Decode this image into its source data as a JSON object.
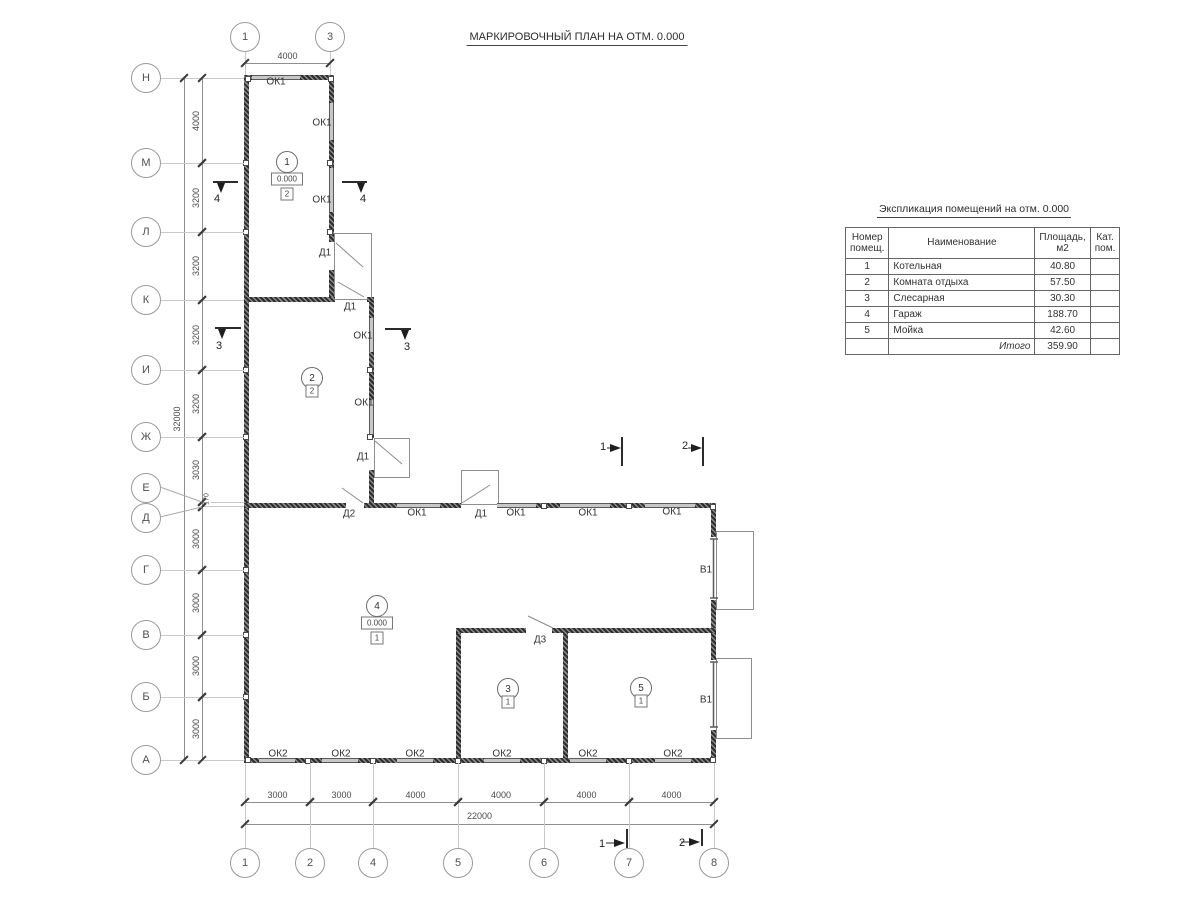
{
  "title": "МАРКИРОВОЧНЫЙ ПЛАН НА ОТМ. 0.000",
  "explication": {
    "title": "Экспликация помещений на отм. 0.000",
    "h_num1": "Номер",
    "h_num2": "помещ.",
    "h_name": "Наименование",
    "h_area": "Площадь,  м2",
    "h_cat1": "Кат.",
    "h_cat2": "пом.",
    "rows": [
      {
        "num": "1",
        "name": "Котельная",
        "area": "40.80",
        "cat": ""
      },
      {
        "num": "2",
        "name": "Комната отдыха",
        "area": "57.50",
        "cat": ""
      },
      {
        "num": "3",
        "name": "Слесарная",
        "area": "30.30",
        "cat": ""
      },
      {
        "num": "4",
        "name": "Гараж",
        "area": "188.70",
        "cat": ""
      },
      {
        "num": "5",
        "name": "Мойка",
        "area": "42.60",
        "cat": ""
      }
    ],
    "total_label": "Итого",
    "total_area": "359.90"
  },
  "axes": {
    "left": [
      {
        "label": "Н",
        "cy": 78
      },
      {
        "label": "М",
        "cy": 163
      },
      {
        "label": "Л",
        "cy": 232
      },
      {
        "label": "К",
        "cy": 300
      },
      {
        "label": "И",
        "cy": 370
      },
      {
        "label": "Ж",
        "cy": 437
      },
      {
        "label": "Е",
        "cy": 488,
        "ly": 502,
        "leader": true
      },
      {
        "label": "Д",
        "cy": 518,
        "ly": 506,
        "leader": true
      },
      {
        "label": "Г",
        "cy": 570
      },
      {
        "label": "В",
        "cy": 635
      },
      {
        "label": "Б",
        "cy": 697
      },
      {
        "label": "А",
        "cy": 760
      }
    ],
    "top": [
      {
        "label": "1",
        "cx": 245
      },
      {
        "label": "3",
        "cx": 330
      }
    ],
    "bottom": [
      {
        "label": "1",
        "cx": 245
      },
      {
        "label": "2",
        "cx": 310
      },
      {
        "label": "4",
        "cx": 373
      },
      {
        "label": "5",
        "cx": 458
      },
      {
        "label": "6",
        "cx": 544
      },
      {
        "label": "7",
        "cx": 629
      },
      {
        "label": "8",
        "cx": 714
      }
    ]
  },
  "dimensions": {
    "left_segments": [
      {
        "text": "4000",
        "y1": 78,
        "y2": 163
      },
      {
        "text": "3200",
        "y1": 163,
        "y2": 232
      },
      {
        "text": "3200",
        "y1": 232,
        "y2": 300
      },
      {
        "text": "3200",
        "y1": 300,
        "y2": 370
      },
      {
        "text": "3200",
        "y1": 370,
        "y2": 437
      },
      {
        "text": "3030",
        "y1": 437,
        "y2": 502
      },
      {
        "text": "170",
        "y1": 502,
        "y2": 507,
        "small": true
      },
      {
        "text": "3000",
        "y1": 507,
        "y2": 570
      },
      {
        "text": "3000",
        "y1": 570,
        "y2": 635
      },
      {
        "text": "3000",
        "y1": 635,
        "y2": 697
      },
      {
        "text": "3000",
        "y1": 697,
        "y2": 760
      }
    ],
    "left_total": {
      "text": "32000",
      "y1": 78,
      "y2": 760
    },
    "bottom_segments": [
      {
        "text": "3000",
        "x1": 245,
        "x2": 310
      },
      {
        "text": "3000",
        "x1": 310,
        "x2": 373
      },
      {
        "text": "4000",
        "x1": 373,
        "x2": 458
      },
      {
        "text": "4000",
        "x1": 458,
        "x2": 544
      },
      {
        "text": "4000",
        "x1": 544,
        "x2": 629
      },
      {
        "text": "4000",
        "x1": 629,
        "x2": 714
      }
    ],
    "bottom_total": {
      "text": "22000",
      "x1": 245,
      "x2": 714
    },
    "top_segments": [
      {
        "text": "4000",
        "x1": 245,
        "x2": 330
      }
    ]
  },
  "rooms": [
    {
      "number": "1",
      "elevation": "0.000",
      "category": "2",
      "x": 287,
      "y": 162
    },
    {
      "number": "2",
      "category": "2",
      "x": 312,
      "y": 378
    },
    {
      "number": "3",
      "category": "1",
      "x": 508,
      "y": 689
    },
    {
      "number": "4",
      "elevation": "0.000",
      "category": "1",
      "x": 377,
      "y": 606
    },
    {
      "number": "5",
      "category": "1",
      "x": 641,
      "y": 688
    }
  ],
  "opening_labels": [
    {
      "text": "ОК1",
      "x": 276,
      "y": 82
    },
    {
      "text": "ОК1",
      "x": 322,
      "y": 123
    },
    {
      "text": "ОК1",
      "x": 322,
      "y": 200
    },
    {
      "text": "Д1",
      "x": 325,
      "y": 253
    },
    {
      "text": "Д1",
      "x": 350,
      "y": 307
    },
    {
      "text": "ОК1",
      "x": 363,
      "y": 336
    },
    {
      "text": "ОК1",
      "x": 364,
      "y": 403
    },
    {
      "text": "Д1",
      "x": 363,
      "y": 457
    },
    {
      "text": "Д2",
      "x": 349,
      "y": 514
    },
    {
      "text": "ОК1",
      "x": 417,
      "y": 513
    },
    {
      "text": "Д1",
      "x": 481,
      "y": 514
    },
    {
      "text": "ОК1",
      "x": 516,
      "y": 513
    },
    {
      "text": "ОК1",
      "x": 588,
      "y": 513
    },
    {
      "text": "ОК1",
      "x": 672,
      "y": 512
    },
    {
      "text": "Д3",
      "x": 540,
      "y": 640
    },
    {
      "text": "В1",
      "x": 706,
      "y": 570
    },
    {
      "text": "В1",
      "x": 706,
      "y": 700
    },
    {
      "text": "ОК2",
      "x": 278,
      "y": 754
    },
    {
      "text": "ОК2",
      "x": 341,
      "y": 754
    },
    {
      "text": "ОК2",
      "x": 415,
      "y": 754
    },
    {
      "text": "ОК2",
      "x": 502,
      "y": 754
    },
    {
      "text": "ОК2",
      "x": 588,
      "y": 754
    },
    {
      "text": "ОК2",
      "x": 673,
      "y": 754
    }
  ],
  "section_labels": [
    {
      "text": "4",
      "x": 217,
      "y": 199
    },
    {
      "text": "4",
      "x": 363,
      "y": 199
    },
    {
      "text": "3",
      "x": 219,
      "y": 346
    },
    {
      "text": "3",
      "x": 407,
      "y": 347
    },
    {
      "text": "1",
      "x": 603,
      "y": 447
    },
    {
      "text": "2",
      "x": 685,
      "y": 446
    },
    {
      "text": "1",
      "x": 602,
      "y": 844
    },
    {
      "text": "2",
      "x": 682,
      "y": 843
    }
  ]
}
